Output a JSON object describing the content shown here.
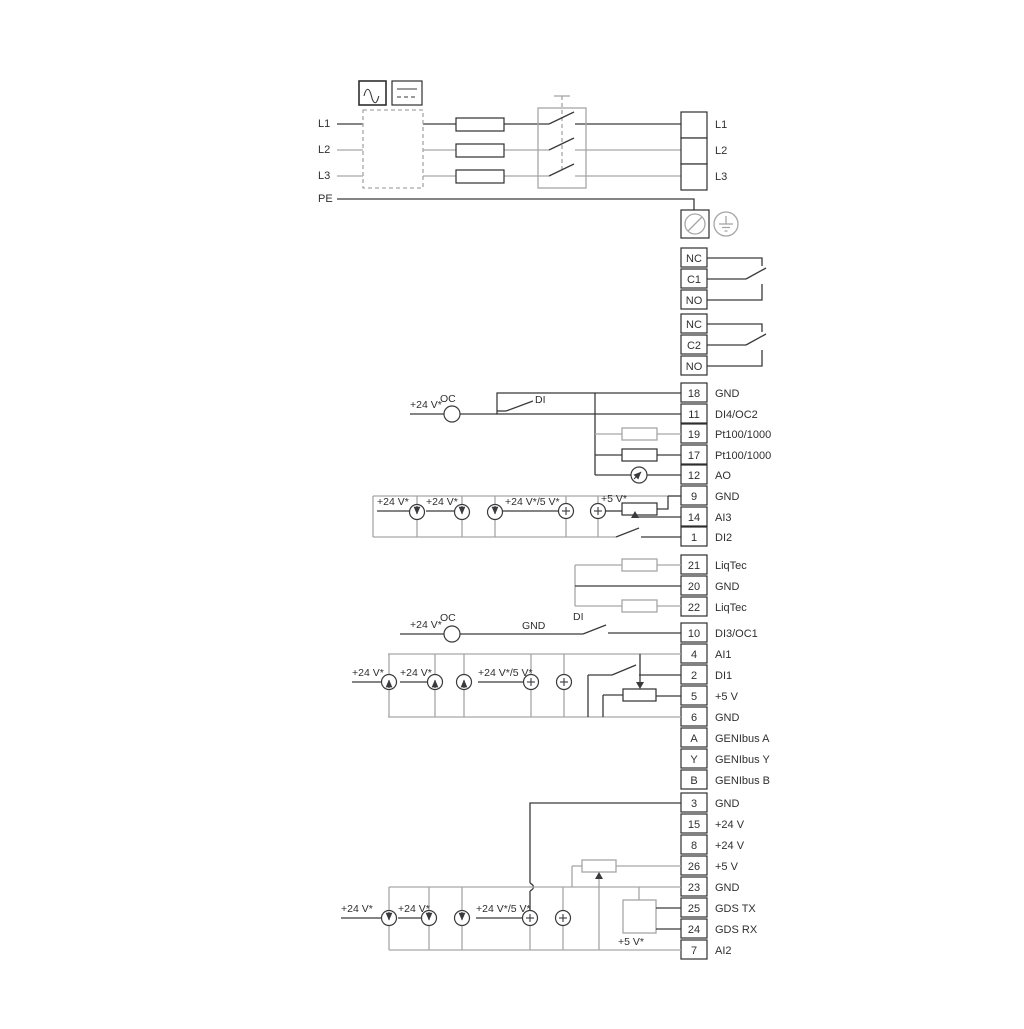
{
  "power": {
    "inputs": [
      "L1",
      "L2",
      "L3"
    ],
    "pe": "PE",
    "outputs": [
      "L1",
      "L2",
      "L3"
    ]
  },
  "relay1": [
    "NC",
    "C1",
    "NO"
  ],
  "relay2": [
    "NC",
    "C2",
    "NO"
  ],
  "io1": [
    {
      "num": "18",
      "label": "GND"
    },
    {
      "num": "11",
      "label": "DI4/OC2"
    },
    {
      "num": "19",
      "label": "Pt100/1000"
    },
    {
      "num": "17",
      "label": "Pt100/1000"
    },
    {
      "num": "12",
      "label": "AO"
    },
    {
      "num": "9",
      "label": "GND"
    },
    {
      "num": "14",
      "label": "AI3"
    },
    {
      "num": "1",
      "label": "DI2"
    }
  ],
  "liqtec": [
    {
      "num": "21",
      "label": "LiqTec"
    },
    {
      "num": "20",
      "label": "GND"
    },
    {
      "num": "22",
      "label": "LiqTec"
    }
  ],
  "io2": [
    {
      "num": "10",
      "label": "DI3/OC1"
    },
    {
      "num": "4",
      "label": "AI1"
    },
    {
      "num": "2",
      "label": "DI1"
    },
    {
      "num": "5",
      "label": "+5 V"
    },
    {
      "num": "6",
      "label": "GND"
    },
    {
      "num": "A",
      "label": "GENIbus A"
    },
    {
      "num": "Y",
      "label": "GENIbus Y"
    },
    {
      "num": "B",
      "label": "GENIbus B"
    }
  ],
  "io3": [
    {
      "num": "3",
      "label": "GND"
    },
    {
      "num": "15",
      "label": "+24 V"
    },
    {
      "num": "8",
      "label": "+24 V"
    },
    {
      "num": "26",
      "label": "+5 V"
    },
    {
      "num": "23",
      "label": "GND"
    },
    {
      "num": "25",
      "label": "GDS TX"
    },
    {
      "num": "24",
      "label": "GDS RX"
    },
    {
      "num": "7",
      "label": "AI2"
    }
  ],
  "annotations": {
    "v24": "+24 V*",
    "v24_5": "+24 V*/5 V*",
    "v5": "+5 V*",
    "oc": "OC",
    "di": "DI",
    "gnd": "GND"
  },
  "colors": {
    "line": "#3a3a3c",
    "muted": "#a6a6a8",
    "text": "#2f2f31",
    "background": "#ffffff"
  }
}
